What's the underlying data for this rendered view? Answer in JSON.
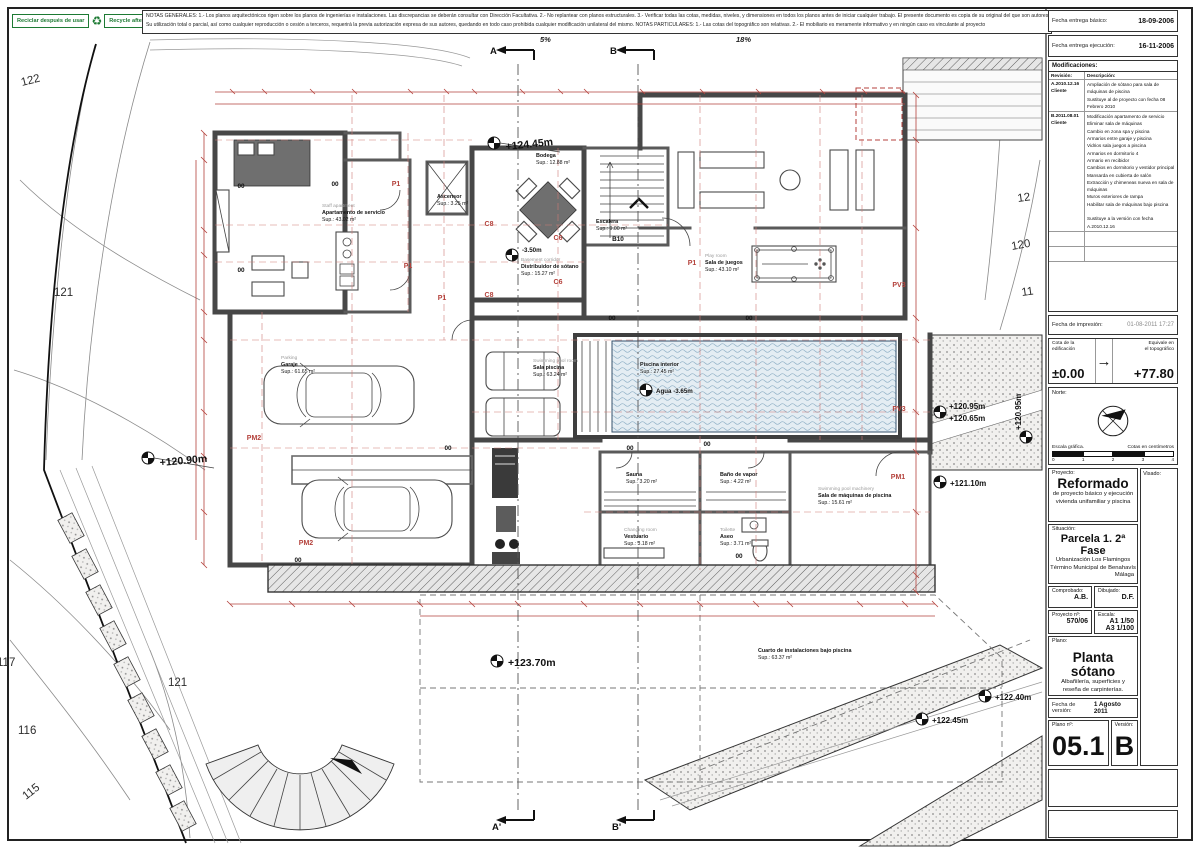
{
  "recycle": {
    "es": "Reciclar después de usar",
    "en": "Recycle after use"
  },
  "notes": {
    "line1": "NOTAS GENERALES:   1.- Los planos arquitectónicos rigen sobre los planos de ingenierías e instalaciones. Las discrepancias se deberán consultar con Dirección Facultativa.   2.- No replantear con planos estructurales.   3.- Verificar todas las cotas, medidas, niveles, y dimensiones en todos los planos antes de iniciar cualquier trabajo. El presente documento es copia de su original del que son autores los arquitectos",
    "line2": "Su utilización total o parcial, así como cualquier reproducción o cesión a terceros, requerirá la previa autorización expresa de sus autores, quedando en todo caso prohibida cualquier modificación unilateral del mismo.   NOTAS PARTICULARES:   1.- Las cotas del topográfico son relativas. 2.- El mobiliario es meramente informativo y en ningún caso es vinculante al proyecto"
  },
  "titleblock": {
    "fecha_basico_label": "Fecha entrega básico:",
    "fecha_basico": "18-09-2006",
    "fecha_ejecucion_label": "Fecha entrega ejecución:",
    "fecha_ejecucion": "16-11-2006",
    "modificaciones_label": "Modificaciones:",
    "revision_header": "Revisión:",
    "descripcion_header": "Descripción:",
    "rev_a_id": "A.2010.12.16\nCliente",
    "rev_a_desc": "Ampliación de sótano para sala de máquinas de piscina\nSustituye al de proyecto con fecha 08 Febrero 2010",
    "rev_b_id": "B.2011.08.01\nCliente",
    "rev_b_desc": "Modificación apartamento de servicio\nEliminar sala de máquinas\nCambio en zona spa y piscina\nArmarios entre garaje y piscina\nVidrios sala juegos a piscina\nArmarios en dormitorio 4\nArmario en recibidor\nCambios en dormitorio y vestidor principal\nMansarda en cubierta de salón\nExtracción y chimeneas nueva en sala de máquinas\nMuros exteriores de rampa\nHabilitar sala de máquinas bajo piscina\n\nSustituye a la versión con fecha A.2010.12.16",
    "impresion_label": "Fecha de impresión:",
    "impresion": "01-08-2011 17:27",
    "cota_label": "Cota de la\nedificación",
    "cota": "±0.00",
    "arrow": "→",
    "equiv_label": "Equivale en\nel topográfico",
    "equiv": "+77.80",
    "norte_label": "Norte:",
    "escala_grafica": "Escala gráfica.",
    "cotas_cm": "Cotas en centímetros",
    "tick0": "0",
    "tick1": "1",
    "tick2": "2",
    "tick3": "3",
    "tick4": "4",
    "proyecto_label": "Proyecto:",
    "proyecto_title": "Reformado",
    "proyecto_sub1": "de proyecto básico y ejecución",
    "proyecto_sub2": "vivienda unifamiliar y piscina",
    "visado_label": "Visado:",
    "situacion_label": "Situación:",
    "situacion_title": "Parcela 1. 2ª Fase",
    "situacion_sub1": "Urbanización Los Flamingos",
    "situacion_sub2": "Término Municipal de Benahavís",
    "situacion_sub3": "Málaga",
    "comprobado_label": "Comprobado:",
    "comprobado": "A.B.",
    "dibujado_label": "Dibujado:",
    "dibujado": "D.F.",
    "proyecto_n_label": "Proyecto nº:",
    "proyecto_n": "570/06",
    "escala_label": "Escala:",
    "escala_v": "A1 1/50\nA3 1/100",
    "plano_label": "Plano:",
    "plano_title": "Planta sótano",
    "plano_sub1": "Albañilería, superficies y",
    "plano_sub2": "reseña de carpinterías.",
    "fecha_version_label": "Fecha de versión:",
    "fecha_version": "1 Agosto 2011",
    "plano_n_label": "Plano nº:",
    "plano_n": "05.1",
    "version_label": "Versión:",
    "version": "B"
  },
  "plan": {
    "slope1": "5%",
    "slope2": "18%",
    "sectionA": "A",
    "sectionB": "B",
    "sectionA2": "A'",
    "sectionB2": "B'",
    "levels": {
      "l12445": "+124.45m",
      "l350": "-3.50m",
      "l12090": "+120.90m",
      "l12095a": "+120.95m",
      "l12065": "+120.65m",
      "l12110": "+121.10m",
      "l12095b": "+120.95m",
      "l12370": "+123.70m",
      "l12245": "+122.45m",
      "l12240": "+122.40m",
      "agua": "Agua -3.65m"
    },
    "rooms": {
      "staff": {
        "en": "Staff apartment",
        "es": "Apartamento de servicio",
        "sup": "Sup.: 43.02 m²"
      },
      "ascensor": {
        "es": "Ascensor",
        "sup": "Sup.: 3.25 m²"
      },
      "bodega": {
        "es": "Bodega",
        "sup": "Sup.: 12.88 m²"
      },
      "escalera": {
        "es": "Escalera",
        "sup": "Sup.: 9.00 m²"
      },
      "distribuidor": {
        "en": "Basement corridor",
        "es": "Distribuidor de sótano",
        "sup": "Sup.: 15.27 m²"
      },
      "juegos": {
        "en": "Play room",
        "es": "Sala de juegos",
        "sup": "Sup.: 43.10 m²"
      },
      "salapiscina": {
        "en": "Swimming pool room",
        "es": "Sala piscina",
        "sup": "Sup.: 63.24 m²"
      },
      "piscina": {
        "es": "Piscina interior",
        "sup": "Sup.: 27.45 m²"
      },
      "garaje": {
        "en": "Parking",
        "es": "Garaje",
        "sup": "Sup.: 61.65 m²"
      },
      "sauna": {
        "es": "Sauna",
        "sup": "Sup.: 3.20 m²"
      },
      "vapor": {
        "es": "Baño de vapor",
        "sup": "Sup.: 4.22 m²"
      },
      "vestuario": {
        "en": "Changing room",
        "es": "Vestuario",
        "sup": "Sup.: 3.18 m²"
      },
      "aseo": {
        "en": "Toilette",
        "es": "Aseo",
        "sup": "Sup.: 3.71 m²"
      },
      "maquinas": {
        "en": "Swimming pool machinery",
        "es": "Sala de máquinas de piscina",
        "sup": "Sup.: 15.61 m²"
      },
      "instalaciones": {
        "es": "Cuarto de instalaciones bajo piscina",
        "sup": "Sup.: 63.37 m²"
      }
    },
    "codes": {
      "p1": "P1",
      "c8": "C8",
      "c6": "C6",
      "b10": "B10",
      "pv3": "PV3",
      "pm1": "PM1",
      "pm2": "PM2",
      "oo": "00"
    },
    "contours": {
      "c122": "122",
      "c121": "121",
      "c117": "117",
      "c116": "116",
      "c115": "115",
      "c12": "12",
      "c120": "120",
      "c11": "11"
    }
  }
}
